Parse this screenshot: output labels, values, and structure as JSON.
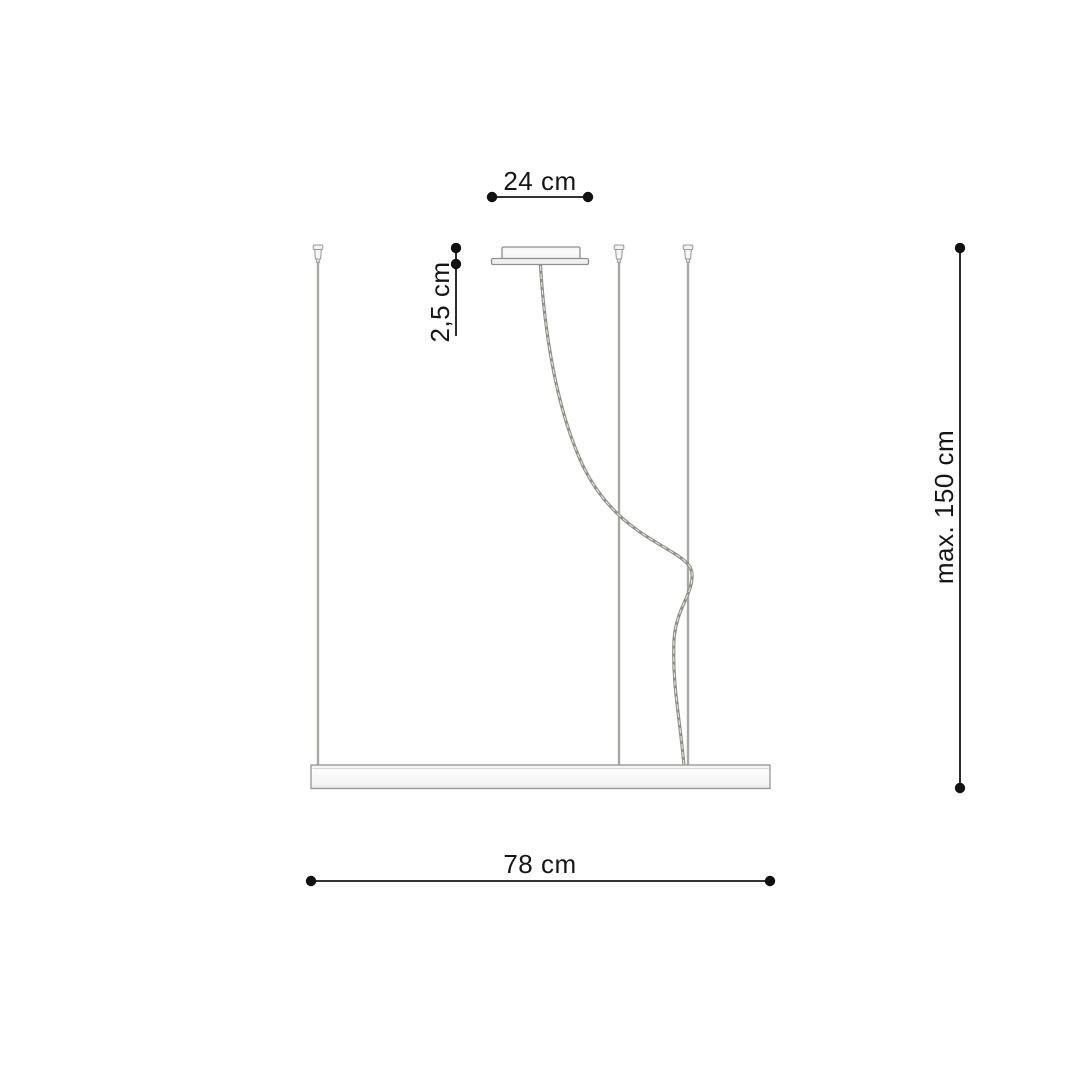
{
  "diagram": {
    "dimensions": {
      "canopy_width": {
        "label": "24 cm"
      },
      "canopy_height": {
        "label": "2,5 cm"
      },
      "suspension_height": {
        "label": "max. 150 cm"
      },
      "fixture_width": {
        "label": "78 cm"
      }
    },
    "colors": {
      "dimension_ink": "#161616",
      "outline_gray": "#969696",
      "wire_gray": "#a9a9a3",
      "fill_light": "#f7f7f7"
    }
  }
}
